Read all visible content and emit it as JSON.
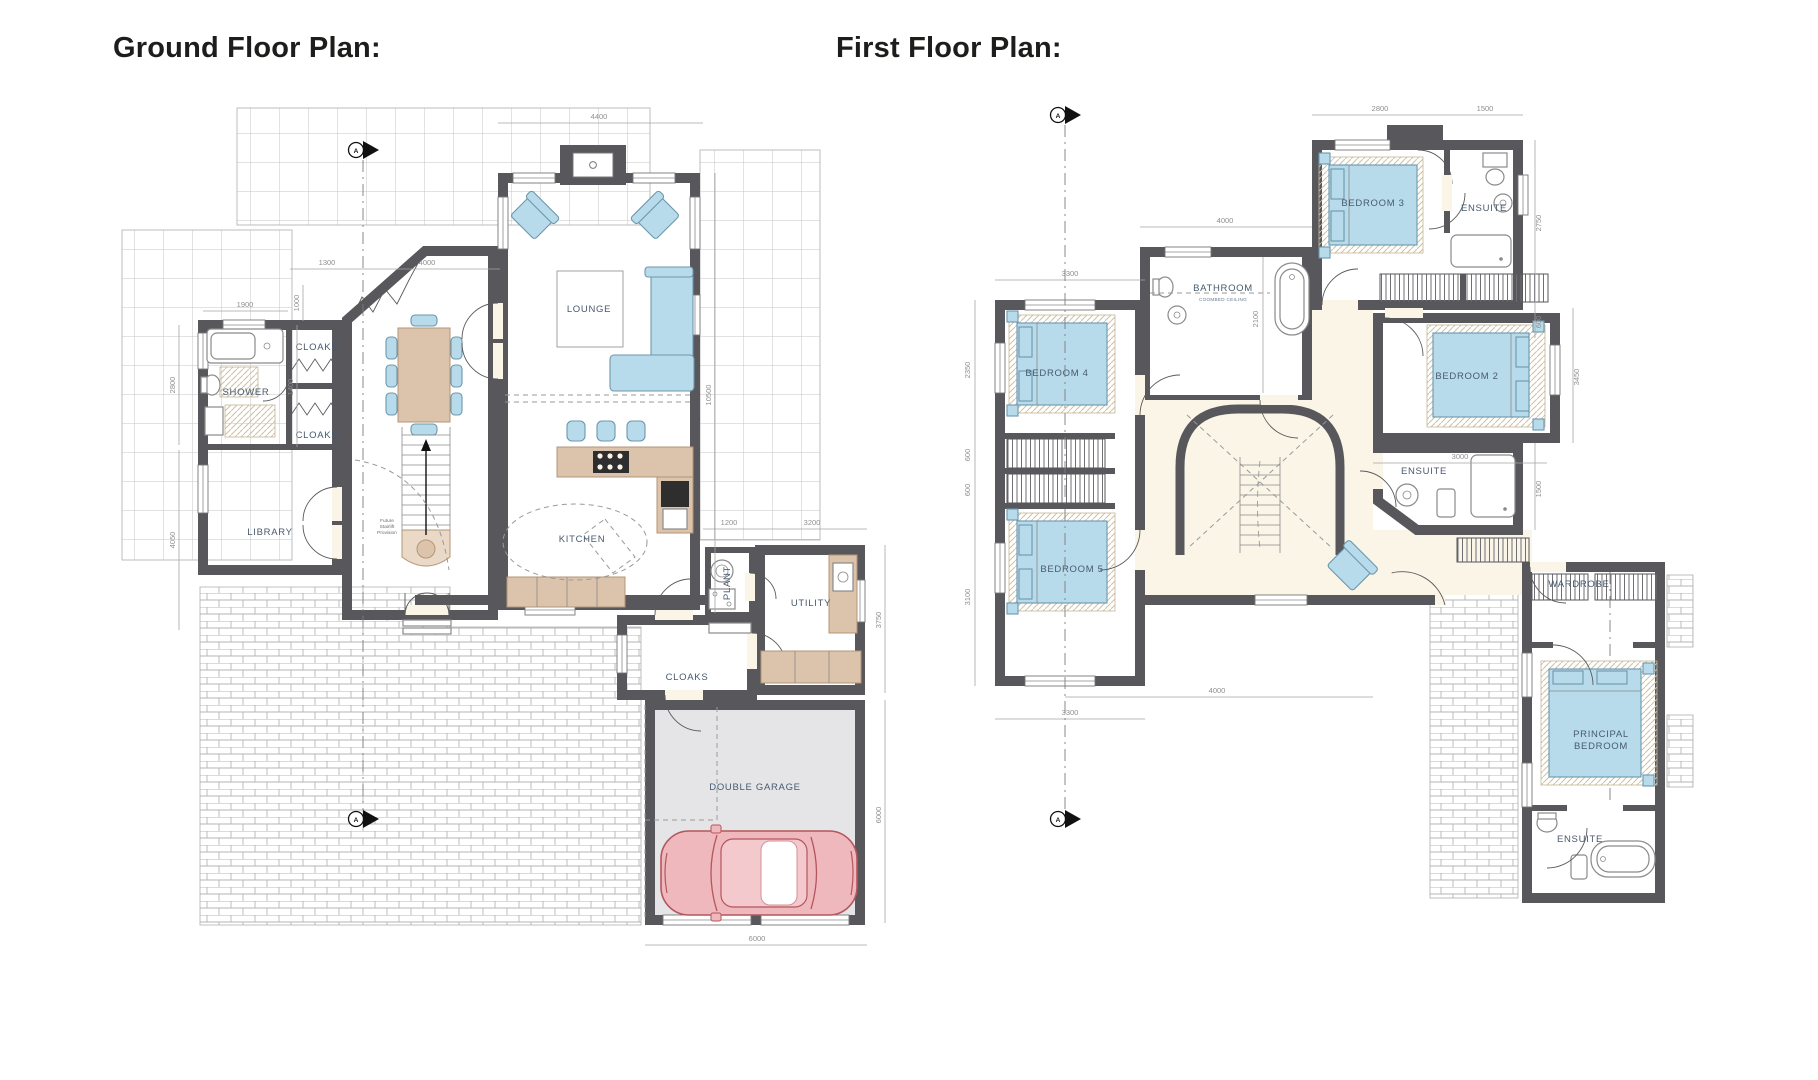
{
  "page": {
    "background": "#ffffff"
  },
  "colors": {
    "wall": "#57575c",
    "floor": "#faf5e7",
    "furniture_blue": "#b8dbeb",
    "wood": "#dcc3ab",
    "garage_floor": "#e5e5e7",
    "car_pink": "#efb8bd",
    "label_text": "#475a6e",
    "dim_text": "#8f8f8f",
    "title_text": "#1d1d1b"
  },
  "ground_floor": {
    "title": "Ground Floor Plan:",
    "section_marker": "A",
    "rooms": {
      "lounge": "LOUNGE",
      "cloaks_top": "CLOAKS",
      "shower": "SHOWER",
      "cloaks_mid": "CLOAKS",
      "library": "LIBRARY",
      "kitchen": "KITCHEN",
      "plant": "PLANT",
      "utility": "UTILITY",
      "cloaks_rear": "CLOAKS",
      "garage": "DOUBLE GARAGE"
    },
    "notes": {
      "l1": "Future",
      "l2": "Stairlift",
      "l3": "Provision"
    },
    "dims": {
      "w4400": "4400",
      "w1300": "1300",
      "w4000": "4000",
      "w1900": "1900",
      "h1000": "1000",
      "h2800": "2800",
      "h1400": "1400",
      "h4050": "4050",
      "h10500": "10500",
      "w1200": "1200",
      "w3200": "3200",
      "h3750": "3750",
      "h6000": "6000",
      "w6000": "6000"
    }
  },
  "first_floor": {
    "title": "First Floor Plan:",
    "section_marker": "A",
    "rooms": {
      "bedroom3": "BEDROOM 3",
      "ensuite_top": "ENSUITE",
      "bathroom": "BATHROOM",
      "bathroom_sub": "COOMBED CEILING",
      "bedroom4": "BEDROOM 4",
      "bedroom5": "BEDROOM 5",
      "bedroom2": "BEDROOM 2",
      "ensuite_mid": "ENSUITE",
      "wardrobe": "WARDROBE",
      "principal_l1": "PRINCIPAL",
      "principal_l2": "BEDROOM",
      "ensuite_bottom": "ENSUITE"
    },
    "dims": {
      "w2800": "2800",
      "w1500": "1500",
      "h2750": "2750",
      "h600r": "600",
      "w4000": "4000",
      "h2100": "2100",
      "w3300": "3300",
      "h2350": "2350",
      "h600a": "600",
      "h600b": "600",
      "h3100": "3100",
      "w3300b": "3300",
      "w4000b": "4000",
      "h3450": "3450",
      "w3000": "3000",
      "h1500": "1500"
    }
  }
}
